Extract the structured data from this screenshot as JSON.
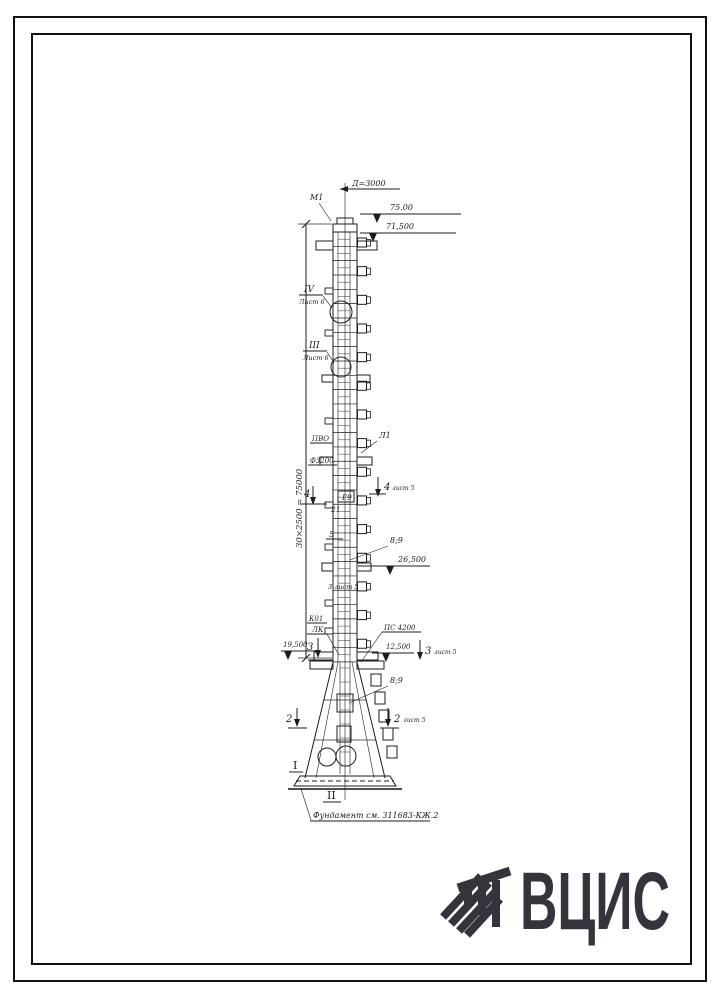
{
  "page": {
    "background": "#ffffff",
    "ink": "#1c1c1e",
    "border_color": "#111111"
  },
  "drawing": {
    "top": {
      "diameter": "Д=3000",
      "mark": "М1"
    },
    "elevations": {
      "e75": "75.00",
      "e71": "71,500",
      "e26": "26,500",
      "e19": "19,500",
      "e12": "12,500"
    },
    "sections": {
      "s4_num": "IV",
      "s4_sheet": "Лист 6",
      "s3_num": "III",
      "s3_sheet": "Лист 6",
      "cut4": "4",
      "cut3": "3",
      "cut2": "2",
      "cut_sheet": "лист 5",
      "mid_note": "3 лист 5",
      "rom1": "I",
      "rom2": "II"
    },
    "labels": {
      "pvo": "ПВО",
      "l1": "Л1",
      "f3200": "Ф3200",
      "g9": "Г9",
      "n21": "21",
      "n5": "5",
      "b89": "8;9",
      "k01": "К01",
      "lk": "ЛК",
      "ps": "ПС 4200"
    },
    "dim_vertical": "30×2500 = 75000",
    "foundation": "Фундамент см. 311683-КЖ.2"
  },
  "logo": {
    "text": "ВЦИС",
    "color": "#34343c"
  }
}
